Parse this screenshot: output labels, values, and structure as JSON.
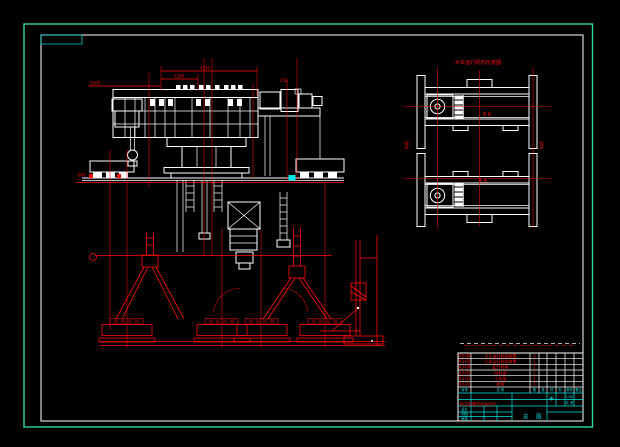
{
  "colors": {
    "background": "#000000",
    "drawing_lines": "#ffffff",
    "dimension_lines": "#ff0b0b",
    "sheet_frame": "#2fd9a1",
    "table_lines": "#00e6e6"
  },
  "front_view": {
    "dim_labels": [
      "4500",
      "1200",
      "3200",
      "600",
      "250"
    ]
  },
  "bogie_view": {
    "title": "大车运行机构示意图",
    "left_side_label": "轨距",
    "right_side_label": "轨距",
    "motor_label_upper": "电 机",
    "motor_label_lower": "电 机"
  },
  "bom": {
    "header": [
      "序号",
      "名 称",
      "数",
      "量",
      "材",
      "料",
      "单件",
      "备注"
    ],
    "rows": [
      {
        "code": "A3-06",
        "name": "大车运行机构装置",
        "qty": "1"
      },
      {
        "code": "A3-05",
        "name": "小车运行机构装置",
        "qty": "1"
      },
      {
        "code": "A3-04",
        "name": "起升机构",
        "qty": "1"
      },
      {
        "code": "A3-03",
        "name": "司机室",
        "qty": "1"
      },
      {
        "code": "A3-02",
        "name": "小车架",
        "qty": "1"
      },
      {
        "code": "A3-01",
        "name": "桥架",
        "qty": "1"
      }
    ]
  },
  "title_block": {
    "project": "桥式起重机总体设计",
    "drawing_title": "总 图",
    "left_labels": [
      "设计",
      "制图",
      "审核"
    ],
    "stamp": "✳",
    "scale": "1:50",
    "sheet": "共 张"
  }
}
